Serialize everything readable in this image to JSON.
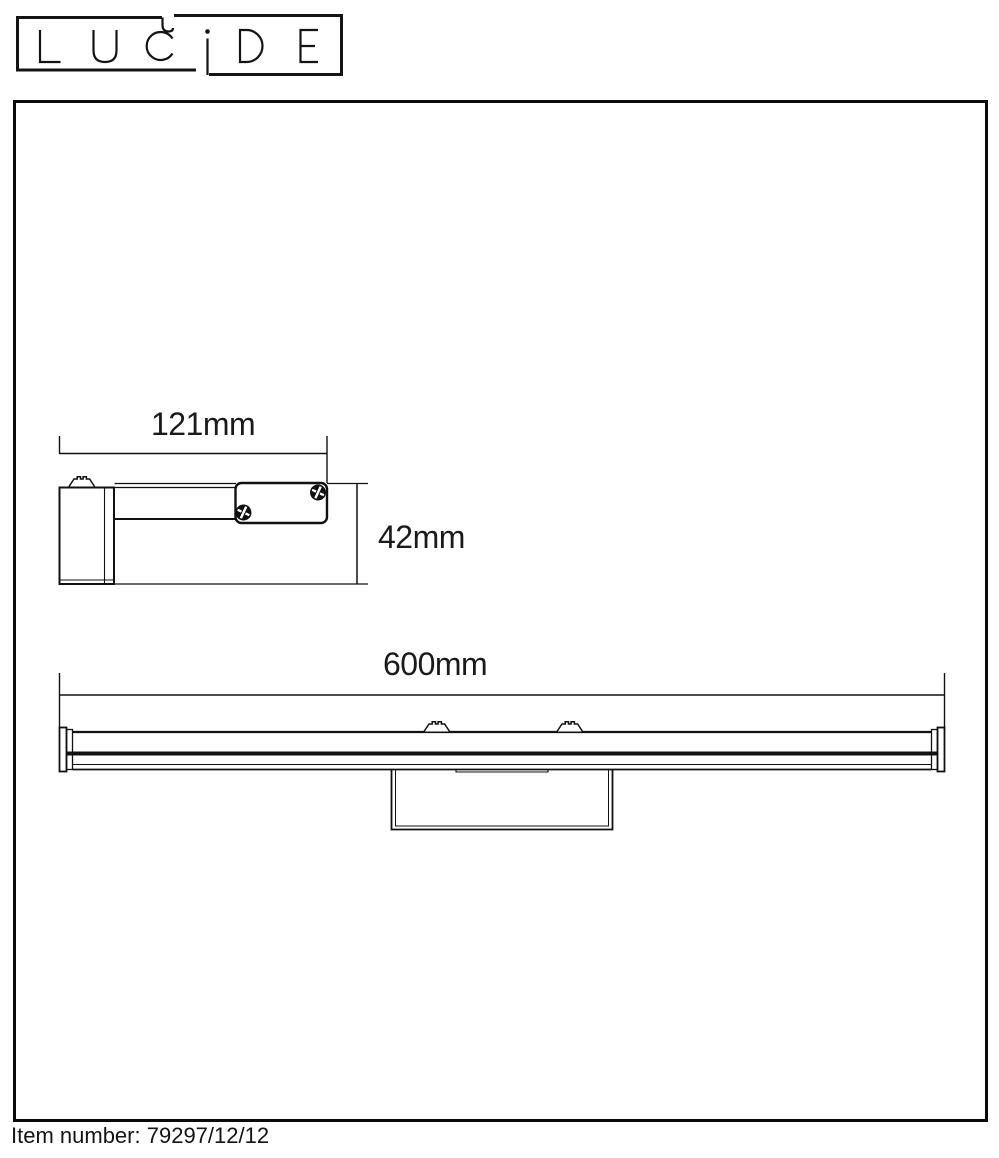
{
  "logo": {
    "text": "LUCIDE"
  },
  "drawing": {
    "side_view": {
      "width_dimension": "121mm",
      "height_dimension": "42mm"
    },
    "front_view": {
      "width_dimension": "600mm"
    }
  },
  "footer": {
    "item_number_label": "Item number:",
    "item_number_value": "79297/12/12"
  },
  "colors": {
    "line": "#111111",
    "background": "#ffffff"
  }
}
